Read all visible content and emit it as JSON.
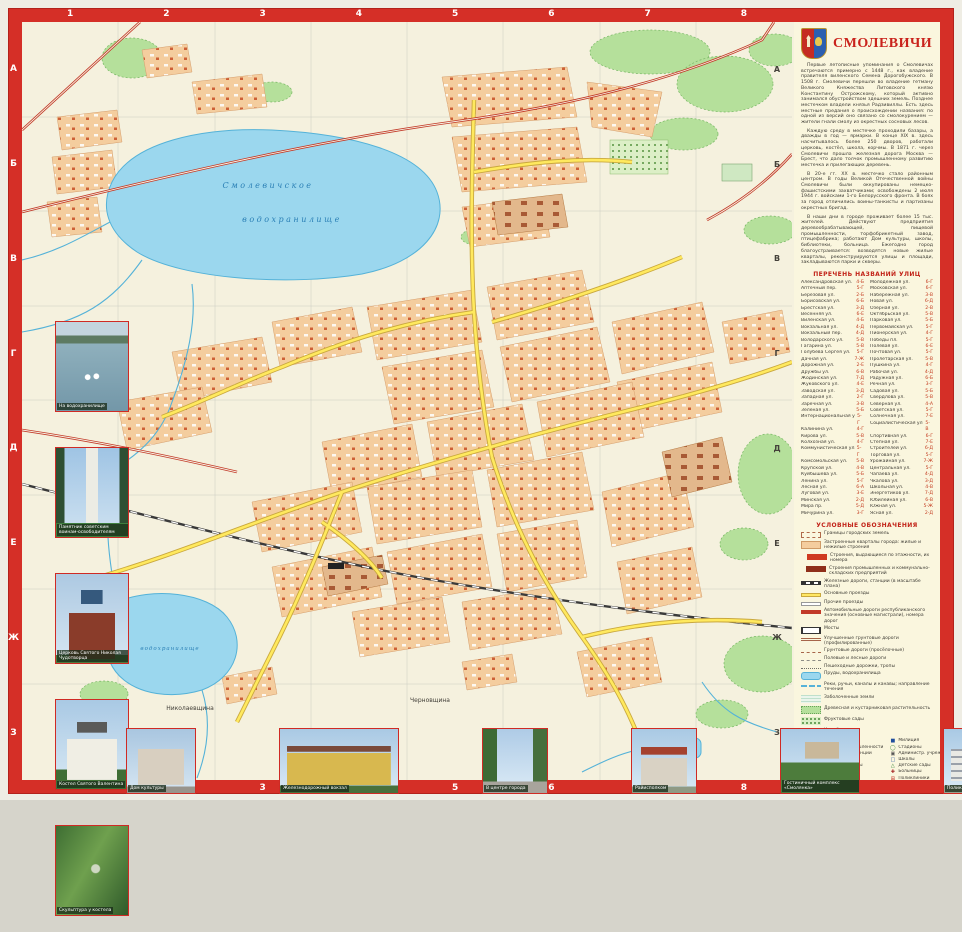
{
  "colors": {
    "frame": "#d52f27",
    "map_bg": "#f5f1de",
    "sidebar_bg": "#faf6de",
    "lake": "#9bd7ee",
    "forest": "#b5e09b",
    "block": "#f4cd9e",
    "road_yellow": "#ffe95e",
    "road_red": "#c23a28",
    "title_red": "#c9231c"
  },
  "title": "СМОЛЕВИЧИ",
  "frame": {
    "top_numbers": [
      "1",
      "2",
      "3",
      "4",
      "5",
      "6",
      "7",
      "8"
    ],
    "bottom_numbers": [
      "1",
      "2",
      "3",
      "4",
      "5",
      "6",
      "7",
      "8"
    ],
    "left_letters": [
      "А",
      "Б",
      "В",
      "Г",
      "Д",
      "Е",
      "Ж",
      "З"
    ],
    "right_letters": [
      "А",
      "Б",
      "В",
      "Г",
      "Д",
      "Е",
      "Ж",
      "З"
    ]
  },
  "map": {
    "labels": {
      "reservoir_line1": "Смолевичское",
      "reservoir_line2": "водохранилище",
      "reservoir_south": "водохранилище",
      "village_west": "Николаевщина",
      "village_east": "Черновщина"
    }
  },
  "sidebar": {
    "history_paragraphs": [
      "Первые летописные упоминания о Смолевичах встречаются примерно с 1448 г., как владение правителя виленского Семена Дорогобужского. В 1508 г. Смолевичи перешли во владение гетману Великого Княжества Литовского князю Константину Острожскому, который активно занимался обустройством здешних земель. Позднее местечком владели князья Радзивиллы. Есть здесь местные предания о происхождении названия: по одной из версий оно связано со смолокурением — жители гнали смолу из окрестных сосновых лесов.",
      "Каждую среду в местечке проходили базары, а дважды в год — ярмарки. В конце XIX в. здесь насчитывалось более 250 дворов, работали церковь, костёл, школа, корчмы. В 1871 г. через Смолевичи прошла железная дорога Москва — Брест, что дало толчок промышленному развитию местечка и прилегающих деревень.",
      "В 20-е гг. XX в. местечко стало районным центром. В годы Великой Отечественной войны Смолевичи были оккупированы немецко-фашистскими захватчиками; освобождены 2 июля 1944 г. войсками 1-го Белорусского фронта. В боях за город отличились воины-танкисты и партизаны окрестных бригад.",
      "В наши дни в городе проживает более 15 тыс. жителей. Действуют предприятия деревообрабатывающей, пищевой промышленности, торфобрикетный завод, птицефабрика; работают Дом культуры, школы, библиотеки, больница. Ежегодно город благоустраивается: возводятся новые жилые кварталы, реконструируются улицы и площади, закладываются парки и скверы."
    ],
    "streets_heading": "ПЕРЕЧЕНЬ НАЗВАНИЙ УЛИЦ",
    "streets": [
      {
        "name": "Александровская ул.",
        "ref": "4-Б"
      },
      {
        "name": "Аптечный пер.",
        "ref": "5-Г"
      },
      {
        "name": "Берёзовая ул.",
        "ref": "2-Б"
      },
      {
        "name": "Борисовская ул.",
        "ref": "6-Б"
      },
      {
        "name": "Брестская ул.",
        "ref": "3-Д"
      },
      {
        "name": "Весенняя ул.",
        "ref": "6-Е"
      },
      {
        "name": "Виленская ул.",
        "ref": "4-Б"
      },
      {
        "name": "Вокзальная ул.",
        "ref": "4-Д"
      },
      {
        "name": "Вокзальный пер.",
        "ref": "4-Д"
      },
      {
        "name": "Володарского ул.",
        "ref": "5-В"
      },
      {
        "name": "Гагарина ул.",
        "ref": "5-В"
      },
      {
        "name": "Голубева Сергея ул.",
        "ref": "5-Г"
      },
      {
        "name": "Дачная ул.",
        "ref": "7-Ж"
      },
      {
        "name": "Дорожная ул.",
        "ref": "2-Е"
      },
      {
        "name": "Дружбы ул.",
        "ref": "6-В"
      },
      {
        "name": "Жодинская ул.",
        "ref": "7-Д"
      },
      {
        "name": "Жуковского ул.",
        "ref": "4-Е"
      },
      {
        "name": "Заводская ул.",
        "ref": "3-Д"
      },
      {
        "name": "Западная ул.",
        "ref": "2-Г"
      },
      {
        "name": "Заречная ул.",
        "ref": "3-В"
      },
      {
        "name": "Зелёная ул.",
        "ref": "5-Б"
      },
      {
        "name": "Интернациональная ул.",
        "ref": "5-Г"
      },
      {
        "name": "Калинина ул.",
        "ref": "4-Г"
      },
      {
        "name": "Кирова ул.",
        "ref": "5-В"
      },
      {
        "name": "Колхозная ул.",
        "ref": "4-Г"
      },
      {
        "name": "Коммунистическая ул.",
        "ref": "5-Г"
      },
      {
        "name": "Комсомольская ул.",
        "ref": "5-В"
      },
      {
        "name": "Крупской ул.",
        "ref": "4-В"
      },
      {
        "name": "Куйбышева ул.",
        "ref": "5-Б"
      },
      {
        "name": "Ленина ул.",
        "ref": "5-Г"
      },
      {
        "name": "Лесная ул.",
        "ref": "6-А"
      },
      {
        "name": "Луговая ул.",
        "ref": "3-Е"
      },
      {
        "name": "Минская ул.",
        "ref": "2-Д"
      },
      {
        "name": "Мира пр.",
        "ref": "5-Д"
      },
      {
        "name": "Мичурина ул.",
        "ref": "3-Г"
      },
      {
        "name": "Молодёжная ул.",
        "ref": "6-Г"
      },
      {
        "name": "Московская ул.",
        "ref": "6-Г"
      },
      {
        "name": "Набережная ул.",
        "ref": "3-В"
      },
      {
        "name": "Новая ул.",
        "ref": "6-Д"
      },
      {
        "name": "Озёрная ул.",
        "ref": "2-В"
      },
      {
        "name": "Октябрьская ул.",
        "ref": "5-В"
      },
      {
        "name": "Парковая ул.",
        "ref": "5-Б"
      },
      {
        "name": "Первомайская ул.",
        "ref": "5-Г"
      },
      {
        "name": "Пионерская ул.",
        "ref": "4-Г"
      },
      {
        "name": "Победы пл.",
        "ref": "5-Г"
      },
      {
        "name": "Полевая ул.",
        "ref": "6-Е"
      },
      {
        "name": "Почтовая ул.",
        "ref": "5-Г"
      },
      {
        "name": "Пролетарская ул.",
        "ref": "5-В"
      },
      {
        "name": "Пушкина ул.",
        "ref": "4-Г"
      },
      {
        "name": "Рабочая ул.",
        "ref": "4-Д"
      },
      {
        "name": "Радужная ул.",
        "ref": "6-Б"
      },
      {
        "name": "Речная ул.",
        "ref": "3-Г"
      },
      {
        "name": "Садовая ул.",
        "ref": "5-Б"
      },
      {
        "name": "Свердлова ул.",
        "ref": "5-В"
      },
      {
        "name": "Северная ул.",
        "ref": "4-А"
      },
      {
        "name": "Советская ул.",
        "ref": "5-Г"
      },
      {
        "name": "Солнечная ул.",
        "ref": "7-Е"
      },
      {
        "name": "Социалистическая ул.",
        "ref": "5-В"
      },
      {
        "name": "Спортивная ул.",
        "ref": "6-Г"
      },
      {
        "name": "Степная ул.",
        "ref": "7-Е"
      },
      {
        "name": "Строителей ул.",
        "ref": "6-Д"
      },
      {
        "name": "Торговая ул.",
        "ref": "5-Г"
      },
      {
        "name": "Урожайная ул.",
        "ref": "7-Ж"
      },
      {
        "name": "Центральная ул.",
        "ref": "5-Г"
      },
      {
        "name": "Чапаева ул.",
        "ref": "4-Д"
      },
      {
        "name": "Чкалова ул.",
        "ref": "3-Д"
      },
      {
        "name": "Школьная ул.",
        "ref": "4-В"
      },
      {
        "name": "Энергетиков ул.",
        "ref": "7-Д"
      },
      {
        "name": "Юбилейная ул.",
        "ref": "6-В"
      },
      {
        "name": "Южная ул.",
        "ref": "5-Ж"
      },
      {
        "name": "Ясная ул.",
        "ref": "2-Д"
      }
    ],
    "legend_heading": "УСЛОВНЫЕ ОБОЗНАЧЕНИЯ",
    "legend": [
      {
        "swatch": "boundary",
        "label": "Границы городских земель"
      },
      {
        "swatch": "blocks",
        "label": "Застроенные кварталы города: жилые и нежилые строения"
      },
      {
        "swatch": "bld",
        "label": "Строения, выдающиеся по этажности, их номера"
      },
      {
        "swatch": "ind",
        "label": "Строения промышленных и коммунально-складских предприятий"
      },
      {
        "swatch": "rail",
        "label": "Железные дороги, станции (в масштабе плана)"
      },
      {
        "swatch": "yroad",
        "label": "Основные проезды"
      },
      {
        "swatch": "wroad",
        "label": "Прочие проезды"
      },
      {
        "swatch": "hwy",
        "label": "Автомобильные дороги республиканского значения (основные магистрали), номера дорог"
      },
      {
        "swatch": "bridge",
        "label": "Мосты"
      },
      {
        "swatch": "improved",
        "label": "Улучшенные грунтовые дороги (профилированные)"
      },
      {
        "swatch": "dirt",
        "label": "Грунтовые дороги (просёлочные)"
      },
      {
        "swatch": "field",
        "label": "Полевые и лесные дороги"
      },
      {
        "swatch": "path",
        "label": "Пешеходные дорожки, тропы"
      },
      {
        "swatch": "pond",
        "label": "Пруды, водохранилища"
      },
      {
        "swatch": "river",
        "label": "Реки, ручьи, каналы и канавы; направление течения"
      },
      {
        "swatch": "swamp",
        "label": "Заболоченные земли"
      },
      {
        "swatch": "forest",
        "label": "Древесная и кустарниковая растительность"
      },
      {
        "swatch": "orchard",
        "label": "Фруктовые сады"
      },
      {
        "swatch": "cemetery",
        "label": "Кладбища"
      }
    ],
    "poi_left": [
      {
        "glyph": "⚑",
        "color": "#c0281e",
        "label": "Райисполком"
      },
      {
        "glyph": "▰",
        "color": "#555",
        "label": "Предприятия промышленности"
      },
      {
        "glyph": "●",
        "color": "#c0281e",
        "label": "Автозаправочные станции"
      },
      {
        "glyph": "⌂",
        "color": "#1f4e9c",
        "label": "Гостиницы"
      },
      {
        "glyph": "★",
        "color": "#c0281e",
        "label": "Дома культуры, клубы"
      },
      {
        "glyph": "▮",
        "color": "#2a7a2a",
        "label": "Библиотеки"
      },
      {
        "glyph": "◆",
        "color": "#c0281e",
        "label": "Музеи"
      },
      {
        "glyph": "◈",
        "color": "#1f4e9c",
        "label": "Банки"
      },
      {
        "glyph": "✉",
        "color": "#1f4e9c",
        "label": "Отделения связи"
      },
      {
        "glyph": "†",
        "color": "#c0281e",
        "label": "Церкви"
      },
      {
        "glyph": "‡",
        "color": "#1f4e9c",
        "label": "Костёлы"
      },
      {
        "glyph": "▲",
        "color": "#2a7a2a",
        "label": "Рынки"
      },
      {
        "glyph": "✚",
        "color": "#c0281e",
        "label": "Аптеки"
      }
    ],
    "poi_right": [
      {
        "glyph": "■",
        "color": "#1f4e9c",
        "label": "Милиция"
      },
      {
        "glyph": "◯",
        "color": "#2a7a2a",
        "label": "Стадионы"
      },
      {
        "glyph": "▣",
        "color": "#555",
        "label": "Администр. учреждения"
      },
      {
        "glyph": "□",
        "color": "#1f4e9c",
        "label": "Школы"
      },
      {
        "glyph": "△",
        "color": "#2a7a2a",
        "label": "Детские сады"
      },
      {
        "glyph": "✚",
        "color": "#a01818",
        "label": "Больницы"
      },
      {
        "glyph": "⊞",
        "color": "#c0281e",
        "label": "Поликлиники"
      },
      {
        "glyph": "▬",
        "color": "#555",
        "label": "Автостанции"
      },
      {
        "glyph": "▌",
        "color": "#c0281e",
        "label": "Памятники, обелиски"
      },
      {
        "glyph": "▲",
        "color": "#a01818",
        "label": "Братские могилы"
      },
      {
        "glyph": "P",
        "color": "#1f4e9c",
        "label": "Автостоянки"
      },
      {
        "glyph": "♨",
        "color": "#c0281e",
        "label": "Бани"
      },
      {
        "glyph": "▪",
        "color": "#555",
        "label": "Прочие учреждения"
      }
    ],
    "scale_line1": "МАСШТАБ 1:10 000",
    "scale_line2": "в 1 сантиметре 100 метров"
  },
  "photos": {
    "left": [
      {
        "kind": "swans",
        "caption": "На водохранилище"
      },
      {
        "kind": "memorial",
        "caption": "Памятник советским воинам-освободителям"
      },
      {
        "kind": "church-red",
        "caption": "Церковь Святого Николая Чудотворца"
      },
      {
        "kind": "kostel",
        "caption": "Костел Святого Валентина"
      },
      {
        "kind": "sculpture",
        "caption": "Скульптура у костела"
      }
    ],
    "bottom": [
      {
        "kind": "bldg1",
        "w": "70px",
        "caption": "Дом культуры"
      },
      {
        "kind": "station",
        "w": "120px",
        "caption": "Железнодорожный вокзал"
      },
      {
        "kind": "street",
        "w": "66px",
        "caption": "В центре города"
      },
      {
        "kind": "admin",
        "w": "66px",
        "caption": "Райисполком"
      },
      {
        "kind": "hotel",
        "w": "80px",
        "caption": "Гостиничный комплекс «Смолянка»"
      },
      {
        "kind": "clinic",
        "w": "70px",
        "caption": "Поликлиника"
      }
    ]
  }
}
